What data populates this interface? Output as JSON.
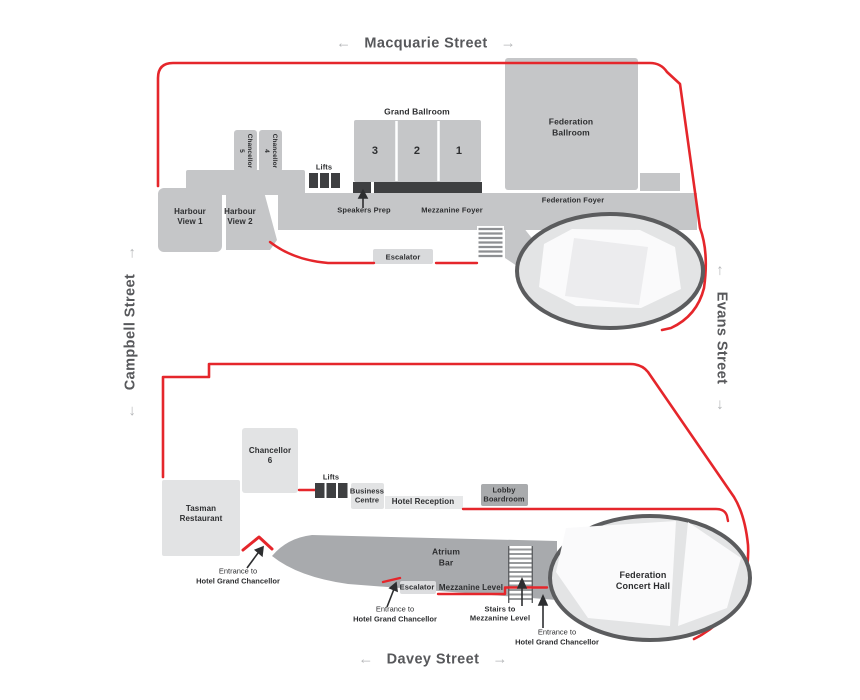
{
  "colors": {
    "outline_red": "#e5262b",
    "hall_border_gray": "#5b5c5e",
    "room_gray": "#c5c6c8",
    "room_light_gray": "#e2e3e4",
    "dark_gray": "#3e3f41",
    "street_text": "#57585b"
  },
  "streets": {
    "top": "Macquarie Street",
    "left": "Campbell Street",
    "right": "Evans Street",
    "bottom": "Davey Street",
    "arrow_left": "←",
    "arrow_right": "→"
  },
  "upper_level": {
    "grand_ballroom_title": "Grand Ballroom",
    "grand_ballroom_rooms": [
      "3",
      "2",
      "1"
    ],
    "federation_ballroom": "Federation\nBallroom",
    "chancellor_5": "Chancellor\n5",
    "chancellor_4": "Chancellor\n4",
    "lifts": "Lifts",
    "speakers_prep": "Speakers Prep",
    "mezzanine_foyer": "Mezzanine Foyer",
    "federation_foyer": "Federation Foyer",
    "harbour_view_1": "Harbour\nView 1",
    "harbour_view_2": "Harbour\nView 2",
    "escalator": "Escalator"
  },
  "ground_level": {
    "chancellor_6": "Chancellor\n6",
    "tasman_restaurant": "Tasman\nRestaurant",
    "lifts": "Lifts",
    "business_centre": "Business\nCentre",
    "hotel_reception": "Hotel Reception",
    "lobby_boardroom": "Lobby\nBoardroom",
    "atrium_bar": "Atrium\nBar",
    "escalator": "Escalator",
    "mezzanine_level": "Mezzanine Level",
    "stairs_to_mezzanine": "Stairs to\nMezzanine Level",
    "federation_concert_hall": "Federation\nConcert Hall",
    "entrance_line1": "Entrance to",
    "entrance_line2": "Hotel Grand Chancellor"
  }
}
